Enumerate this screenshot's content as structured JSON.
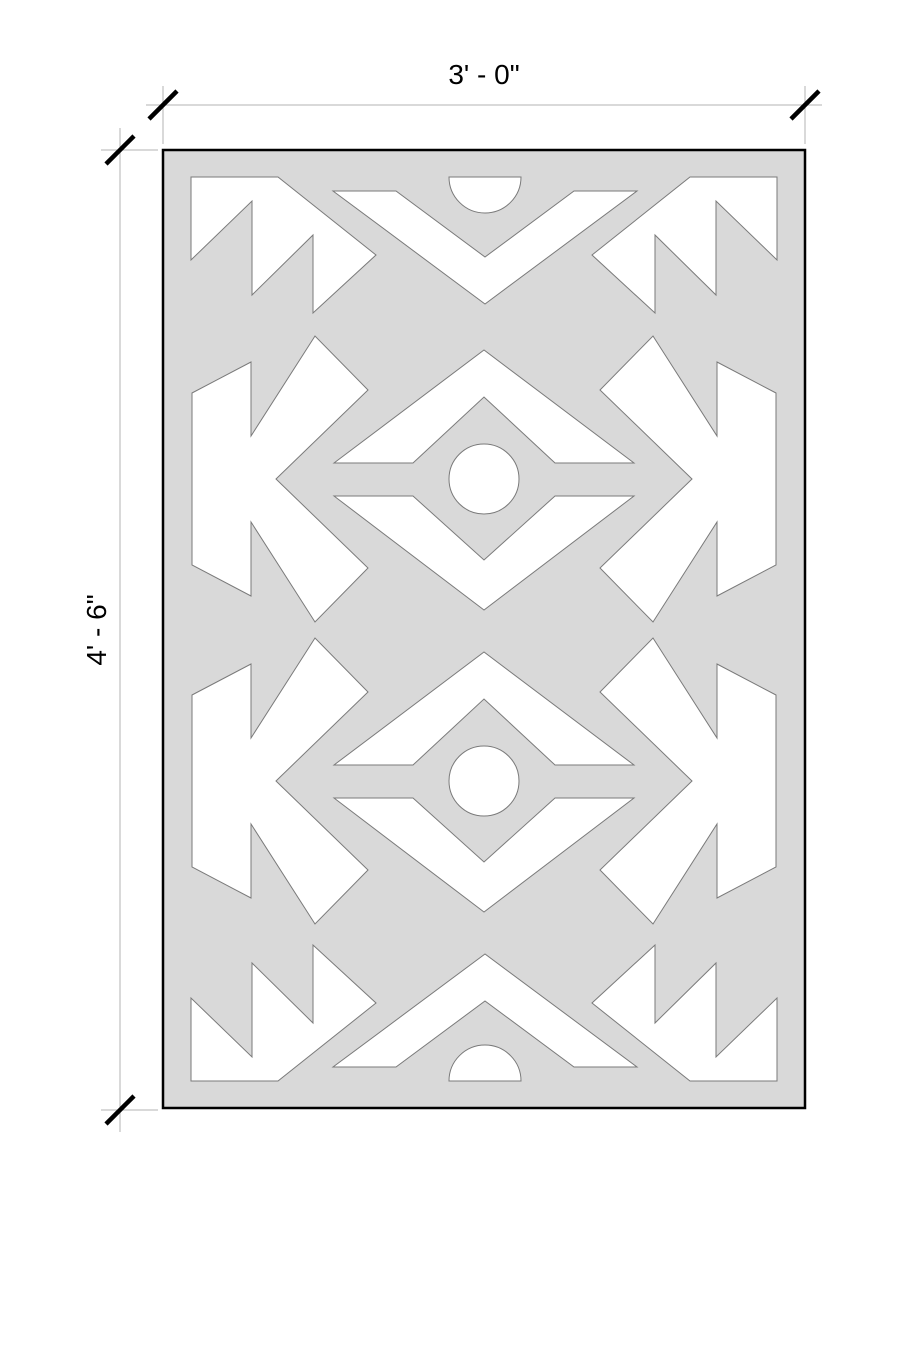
{
  "drawing": {
    "kind": "dimensioned plan view of rectangular patterned panel (rug)",
    "dimensions": {
      "width_label": "3' - 0\"",
      "height_label": "4' - 6\""
    },
    "pattern": {
      "motifs": [
        "corner sawtooth triangles (4 corners)",
        "top chevron band with semicircle notch",
        "bottom chevron band with semicircle notch",
        "two diamond eye medallions with center circles",
        "side sawtooth arrow motifs with gray arrowhead notches"
      ]
    },
    "palette": {
      "page_background": "#ffffff",
      "rug_fill": "#d9d9d9",
      "cutout_fill": "#ffffff",
      "pattern_outline": "#7a7a7a",
      "rug_border": "#000000",
      "dimension_line": "#b3b3b3",
      "tick_mark": "#000000",
      "label_text": "#000000"
    }
  }
}
